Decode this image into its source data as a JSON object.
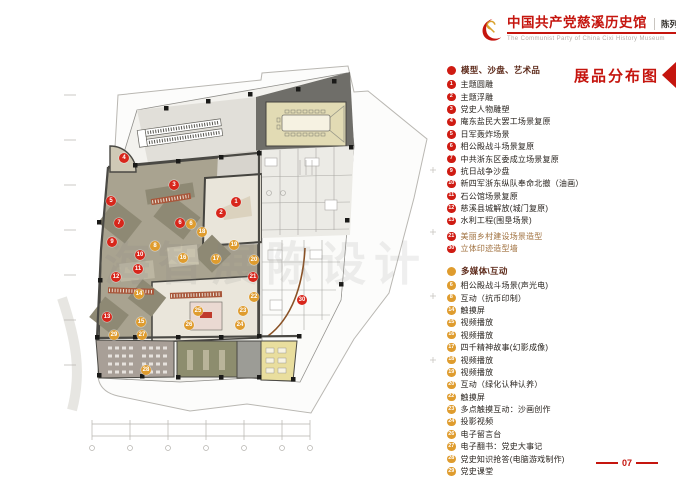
{
  "header": {
    "logo_icon": "party-emblem-icon",
    "title": "中国共产党慈溪历史馆",
    "subtitle": "陈列布展设计施工方案",
    "title_en": "The Communist Party of China Cixi  History Museum"
  },
  "map_title": "展品分布图",
  "page_number": "07",
  "watermark": "海智展陈设计",
  "colors": {
    "accent_red": "#c5150e",
    "badge_red": "#cf1b12",
    "badge_gold": "#df9c2e",
    "marker_red": "#d8261b",
    "marker_gold": "#df9c2e"
  },
  "legend": {
    "groups": [
      {
        "label": "模型、沙盘、艺术品",
        "dot_color": "#cf1b12",
        "badge_color": "#cf1b12",
        "items": [
          {
            "num": "1",
            "text": "主题圆雕"
          },
          {
            "num": "2",
            "text": "主题浮雕"
          },
          {
            "num": "3",
            "text": "党史人物雕塑"
          },
          {
            "num": "4",
            "text": "庵东盐民大罢工场景复原"
          },
          {
            "num": "5",
            "text": "日军轰炸场景"
          },
          {
            "num": "6",
            "text": "相公殿战斗场景复原"
          },
          {
            "num": "7",
            "text": "中共浙东区委成立场景复原"
          },
          {
            "num": "9",
            "text": "抗日战争沙盘"
          },
          {
            "num": "10",
            "text": "新四军浙东纵队奉命北撤（油画）"
          },
          {
            "num": "11",
            "text": "石公馆场景复原"
          },
          {
            "num": "12",
            "text": "慈溪县城解放(城门复原)"
          },
          {
            "num": "13",
            "text": "水利工程(围垦场景)"
          },
          {
            "num": "21",
            "text": "美丽乡村建设场景造型",
            "tint": "#a0713f",
            "gap": true
          },
          {
            "num": "30",
            "text": "立体印迹造型墙",
            "tint": "#a0713f"
          }
        ]
      },
      {
        "label": "多媒体\\互动",
        "dot_color": "#df9c2e",
        "badge_color": "#df9c2e",
        "items": [
          {
            "num": "6",
            "text": "相公殿战斗场景(声光电)"
          },
          {
            "num": "8",
            "text": "互动（抗币印制）"
          },
          {
            "num": "14",
            "text": "触摸屏"
          },
          {
            "num": "15",
            "text": "视频播放"
          },
          {
            "num": "16",
            "text": "视频播放"
          },
          {
            "num": "17",
            "text": "四千精神故事(幻影成像)"
          },
          {
            "num": "18",
            "text": "视频播放"
          },
          {
            "num": "19",
            "text": "视频播放"
          },
          {
            "num": "20",
            "text": "互动（绿化认种认养）"
          },
          {
            "num": "22",
            "text": "触摸屏"
          },
          {
            "num": "23",
            "text": "多点触摸互动：沙画创作"
          },
          {
            "num": "24",
            "text": "投影视频"
          },
          {
            "num": "26",
            "text": "电子留言台"
          },
          {
            "num": "27",
            "text": "电子翻书：党史大事记"
          },
          {
            "num": "28",
            "text": "党史知识抢答(电脑游戏制作)"
          },
          {
            "num": "29",
            "text": "党史课堂"
          }
        ]
      }
    ]
  },
  "plan": {
    "markers": [
      {
        "num": "1",
        "type": "red",
        "x": 236,
        "y": 202
      },
      {
        "num": "2",
        "type": "red",
        "x": 221,
        "y": 213
      },
      {
        "num": "3",
        "type": "red",
        "x": 174,
        "y": 185
      },
      {
        "num": "4",
        "type": "red",
        "x": 124,
        "y": 158
      },
      {
        "num": "5",
        "type": "red",
        "x": 111,
        "y": 201
      },
      {
        "num": "6",
        "type": "red",
        "x": 180,
        "y": 223
      },
      {
        "num": "7",
        "type": "red",
        "x": 119,
        "y": 223
      },
      {
        "num": "9",
        "type": "red",
        "x": 112,
        "y": 242
      },
      {
        "num": "10",
        "type": "red",
        "x": 140,
        "y": 255
      },
      {
        "num": "11",
        "type": "red",
        "x": 138,
        "y": 269
      },
      {
        "num": "12",
        "type": "red",
        "x": 116,
        "y": 277
      },
      {
        "num": "13",
        "type": "red",
        "x": 107,
        "y": 317
      },
      {
        "num": "21",
        "type": "red",
        "x": 253,
        "y": 277
      },
      {
        "num": "30",
        "type": "red",
        "x": 302,
        "y": 300
      },
      {
        "num": "6",
        "type": "gold",
        "x": 191,
        "y": 224
      },
      {
        "num": "8",
        "type": "gold",
        "x": 155,
        "y": 246
      },
      {
        "num": "14",
        "type": "gold",
        "x": 139,
        "y": 294
      },
      {
        "num": "15",
        "type": "gold",
        "x": 141,
        "y": 322
      },
      {
        "num": "16",
        "type": "gold",
        "x": 183,
        "y": 258
      },
      {
        "num": "17",
        "type": "gold",
        "x": 216,
        "y": 259
      },
      {
        "num": "18",
        "type": "gold",
        "x": 202,
        "y": 232
      },
      {
        "num": "19",
        "type": "gold",
        "x": 234,
        "y": 245
      },
      {
        "num": "20",
        "type": "gold",
        "x": 254,
        "y": 260
      },
      {
        "num": "22",
        "type": "gold",
        "x": 254,
        "y": 297
      },
      {
        "num": "23",
        "type": "gold",
        "x": 243,
        "y": 311
      },
      {
        "num": "24",
        "type": "gold",
        "x": 240,
        "y": 325
      },
      {
        "num": "25",
        "type": "gold",
        "x": 198,
        "y": 311
      },
      {
        "num": "26",
        "type": "gold",
        "x": 189,
        "y": 325
      },
      {
        "num": "27",
        "type": "gold",
        "x": 142,
        "y": 335
      },
      {
        "num": "28",
        "type": "gold",
        "x": 146,
        "y": 370
      },
      {
        "num": "29",
        "type": "gold",
        "x": 114,
        "y": 335
      }
    ]
  }
}
